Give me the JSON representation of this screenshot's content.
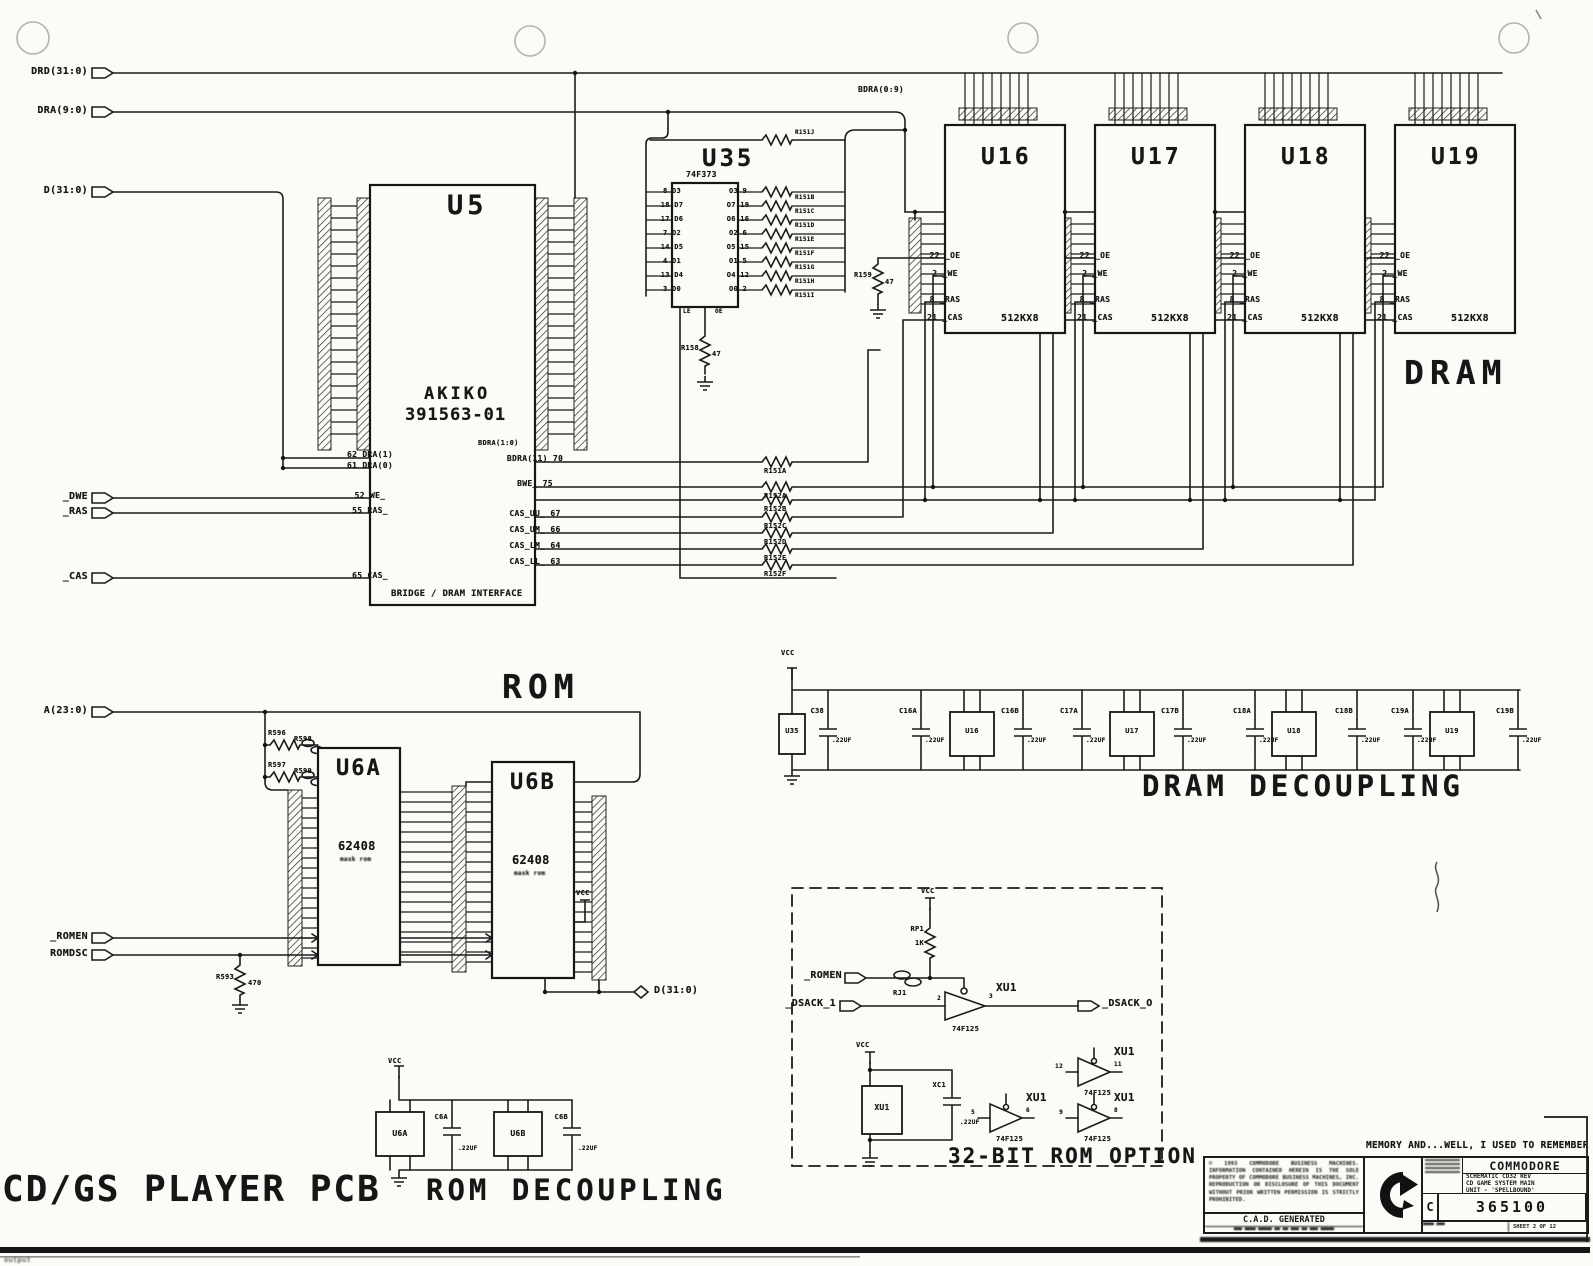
{
  "misc": {
    "vcc": "VCC",
    "dram_label": "DRAM",
    "rom_label": "ROM",
    "pcb_title": "CD/GS PLAYER PCB",
    "corner_text": "output"
  },
  "ports": {
    "drd": "DRD(31:0)",
    "dra": "DRA(9:0)",
    "d_in": "D(31:0)",
    "dwe": "_DWE",
    "ras": "_RAS",
    "cas": "_CAS",
    "a_bus": "A(23:0)",
    "romen": "_ROMEN",
    "romdsc": "ROMDSC",
    "d_out": "D(31:0)",
    "bdra": "BDRA(0:9)",
    "bdra10": "BDRA(1:0)"
  },
  "u5": {
    "ref": "U5",
    "name": "AKIKO",
    "part": "391563-01",
    "subtitle": "BRIDGE / DRAM INTERFACE",
    "left_pins": [
      "62 DRA(1)",
      "61 DRA(0)",
      "52 WE_",
      "55 RAS_",
      "65 CAS_"
    ],
    "right_pins": [
      "BDRA(11) 70",
      "BWE_ 75",
      "CAS_UU_ 67",
      "CAS_UM_ 66",
      "CAS_LM_ 64",
      "CAS_LL_ 63"
    ],
    "resistors": [
      "R151A",
      "R152A",
      "R152B",
      "R152C",
      "R152D",
      "R152E",
      "R152F"
    ]
  },
  "u35": {
    "ref": "U35",
    "part": "74F373",
    "left_pins": [
      "8 D3",
      "18 D7",
      "17 D6",
      "7 D2",
      "14 D5",
      "4 D1",
      "13 D4",
      "3 D0"
    ],
    "right_pins": [
      "O3 9",
      "O7 19",
      "O6 16",
      "O2 6",
      "O5 15",
      "O1 5",
      "O4 12",
      "O0 2"
    ],
    "resistors": [
      "R151J",
      "R151B",
      "R151C",
      "R151D",
      "R151E",
      "R151F",
      "R151G",
      "R151H",
      "R151I"
    ],
    "le": "LE",
    "oe": "OE",
    "r158": "R158",
    "r158_val": "47",
    "r159": "R159",
    "r159_val": "47"
  },
  "dram": {
    "chips": [
      "U16",
      "U17",
      "U18",
      "U19"
    ],
    "part": "512KX8",
    "pin_oe": "22 _OE",
    "pin_we": "2 _WE",
    "pin_ras": "8 _RAS",
    "pin_cas": "21 _CAS"
  },
  "rom": {
    "u6a": "U6A",
    "u6b": "U6B",
    "part": "62408",
    "subpart": "mask rom",
    "resistors": [
      "R596",
      "R598",
      "R597",
      "R599"
    ],
    "r593": "R593",
    "r593_val": "470"
  },
  "dram_decoupling": {
    "title": "DRAM DECOUPLING",
    "caps": [
      "C38",
      "C16A",
      "C16B",
      "C17A",
      "C17B",
      "C18A",
      "C18B",
      "C19A",
      "C19B"
    ],
    "cap_val": ".22UF"
  },
  "rom_decoupling": {
    "title": "ROM DECOUPLING",
    "c6a": "C6A",
    "c6b": "C6B",
    "cap_val": ".22UF"
  },
  "rom_option": {
    "title": "32-BIT ROM OPTION",
    "rp1": "RP1",
    "rp1_val": "1K",
    "rj1": "RJ1",
    "gate_ref": "XU1",
    "gate_part": "74F125",
    "xc1": "XC1",
    "xc1_val": ".22UF",
    "romen": "_ROMEN",
    "dsack_in": "_DSACK_1",
    "dsack_out": "_DSACK_O",
    "pin_in": "2",
    "pin_out": "3",
    "spare_pins": [
      "5",
      "6",
      "12",
      "11",
      "9",
      "8"
    ]
  },
  "titleblock": {
    "note": "MEMORY AND...WELL, I USED TO REMEMBER",
    "company": "COMMODORE",
    "title_lines": [
      "SCHEMATIC CD32 REV",
      "CD GAME SYSTEM MAIN",
      "UNIT - 'SPELLBOUND'"
    ],
    "doc_prefix": "C",
    "doc_number": "365100",
    "sheet": "SHEET 2 OF 12",
    "cad_note": "C.A.D. GENERATED",
    "copyright": "© 1993 COMMODORE BUSINESS MACHINES. INFORMATION CONTAINED HEREIN IS THE SOLE PROPERTY OF COMMODORE BUSINESS MACHINES, INC. REPRODUCTION OR DISCLOSURE OF THIS DOCUMENT WITHOUT PRIOR WRITTEN PERMISSION IS STRICTLY PROHIBITED."
  }
}
